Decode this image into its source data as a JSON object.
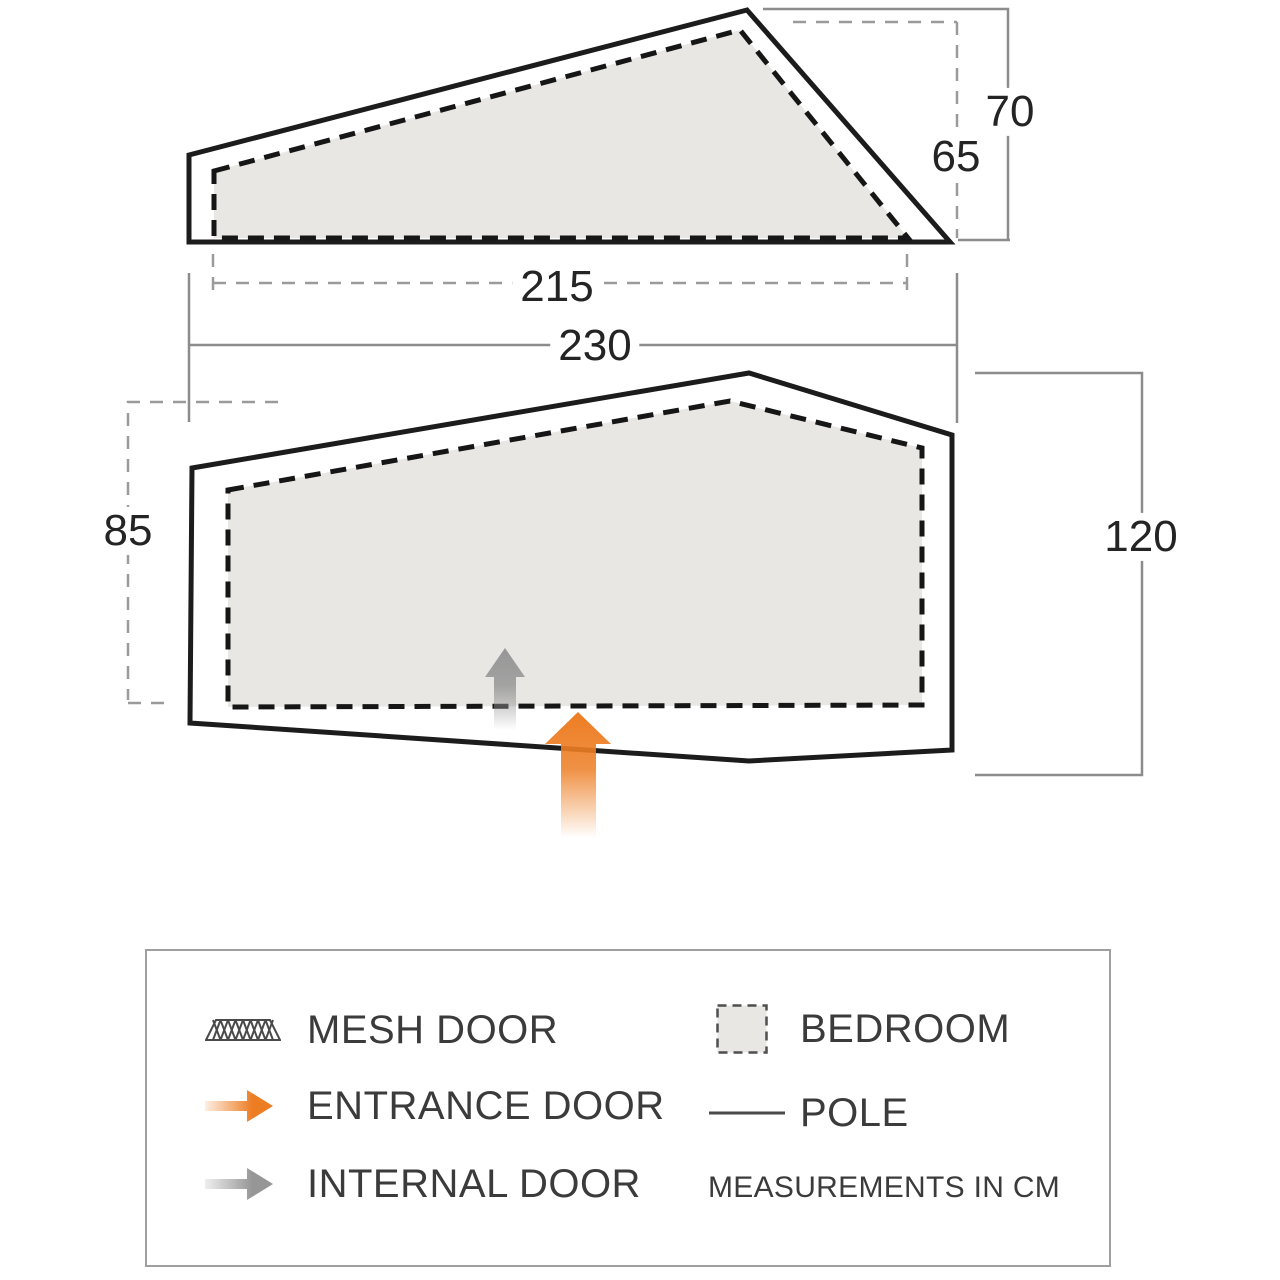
{
  "dims": {
    "outer_height": "70",
    "inner_height": "65",
    "inner_width": "215",
    "outer_width": "230",
    "plan_left": "85",
    "plan_right": "120"
  },
  "legend": {
    "mesh_door": "MESH DOOR",
    "entrance_door": "ENTRANCE DOOR",
    "internal_door": "INTERNAL DOOR",
    "bedroom": "BEDROOM",
    "pole": "POLE",
    "note": "MEASUREMENTS IN CM"
  },
  "colors": {
    "entrance_orange": "#ed7d23",
    "internal_gray": "#969696",
    "bedroom_fill": "#e9e7e4",
    "outline_black": "#1c1c1c",
    "dimension_gray": "#8c8c8c"
  }
}
